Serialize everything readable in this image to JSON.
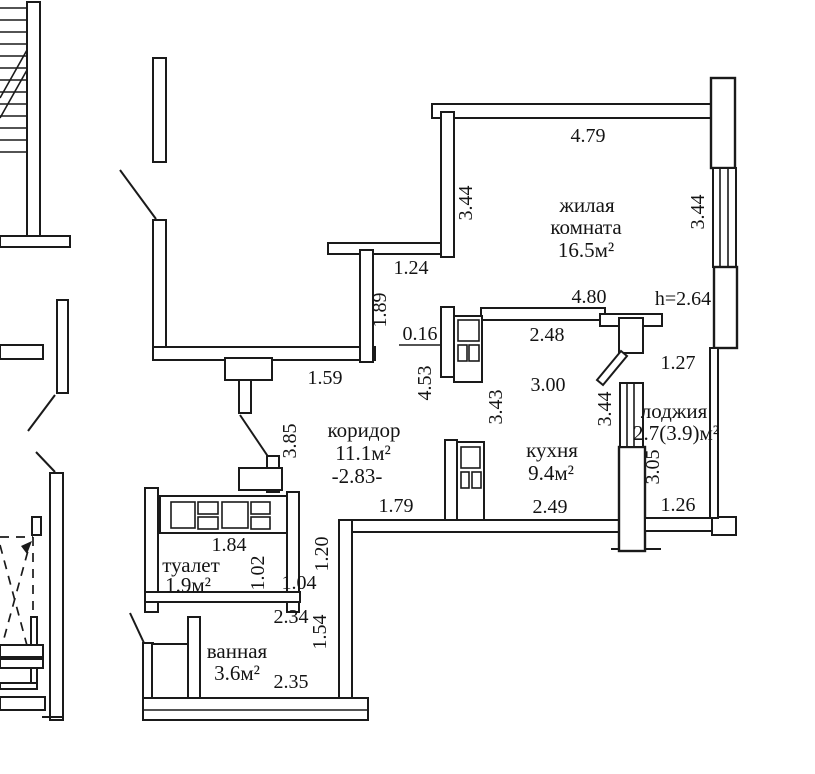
{
  "plan": {
    "type": "apartment floor plan (BTI scan)",
    "ceiling_height_note": "h=2.64",
    "rooms": {
      "living": {
        "name_line1": "жилая",
        "name_line2": "комната",
        "area": "16.5м²"
      },
      "corridor": {
        "name": "коридор",
        "area": "11.1м²",
        "note": "-2.83-"
      },
      "kitchen": {
        "name": "кухня",
        "area": "9.4м²"
      },
      "toilet": {
        "name": "туалет",
        "area": "1.9м²"
      },
      "bath": {
        "name": "ванная",
        "area": "3.6м²"
      },
      "loggia": {
        "name": "лоджия",
        "area": "2.7(3.9)м²"
      }
    },
    "dimensions": {
      "living_top": "4.79",
      "living_left": "3.44",
      "living_right": "3.44",
      "living_bottom": "4.80",
      "hall_opening": "1.24",
      "hall_wall": "1.89",
      "hall_bottom": "1.59",
      "door_offset": "0.16",
      "corridor_top": "2.48",
      "corridor_wall": "4.53",
      "kitchen_top": "3.00",
      "kitchen_height": "3.43",
      "loggia_wall": "3.44",
      "loggia_top": "1.27",
      "loggia_side": "3.05",
      "loggia_bottom": "1.26",
      "corridor_left": "3.85",
      "corridor_bottom": "1.79",
      "kitchen_bottom": "2.49",
      "toilet_top": "1.84",
      "toilet_right": "1.02",
      "lobby_width": "1.04",
      "wall_upper": "1.20",
      "bath_top": "2.34",
      "wall_lower": "1.54",
      "bath_bottom": "2.35"
    },
    "colors": {
      "ink": "#1a1a1a",
      "paper": "#ffffff"
    }
  }
}
